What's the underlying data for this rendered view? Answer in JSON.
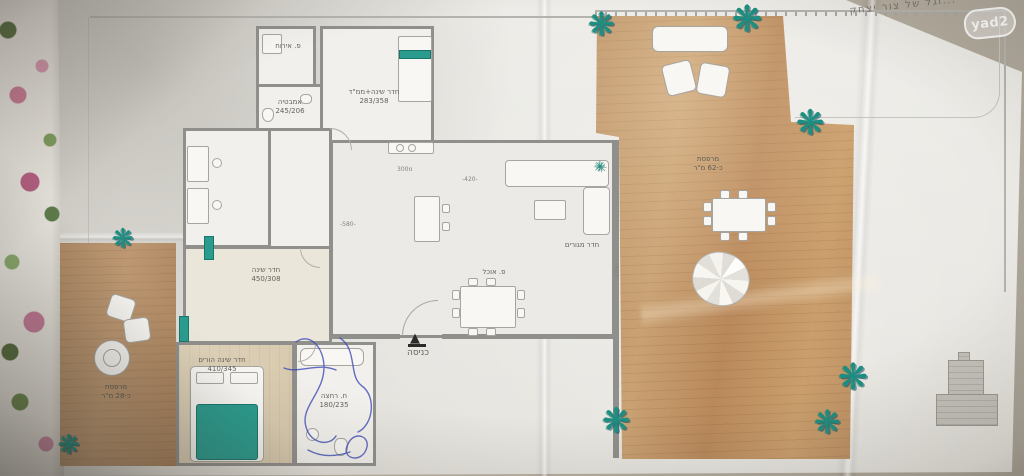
{
  "watermark": {
    "label": "yad2"
  },
  "handwriting": {
    "line": "...וגל של צור יצחק"
  },
  "icons": {
    "palm": "❋",
    "plant": "✳",
    "entrance_arrow": "▲"
  },
  "plan": {
    "rooms": {
      "guest": {
        "label": "פ. אירוח"
      },
      "bath_top": {
        "label": "אמבטיה",
        "dims": "245/206"
      },
      "mamad": {
        "label": "חדר שינה+ממ\"ד",
        "dims": "283/358"
      },
      "living": {
        "label": "חדר מגורים"
      },
      "dining": {
        "label": "פ. אוכל"
      },
      "entrance": {
        "label": "כניסה"
      },
      "bedroom2": {
        "label": "חדר שינה",
        "dims": "450/308"
      },
      "parents": {
        "label": "חדר שינה הורים",
        "dims": "410/345"
      },
      "bath2": {
        "label": "ח. רחצה",
        "dims": "180/235"
      }
    },
    "terraces": {
      "main": {
        "label": "מרפסת",
        "size": "כ-62 מ\"ר"
      },
      "small": {
        "label": "מרפסת",
        "size": "כ-28 מ\"ר"
      }
    },
    "dims": {
      "d300": "מ300",
      "d420": "-420-",
      "d580": "-580-",
      "d585": "-585-"
    }
  },
  "colors": {
    "wood": "#bb9165",
    "teal_accent": "#2a9c8e",
    "pen": "#3a49b4",
    "wall": "#8f8f8c"
  }
}
